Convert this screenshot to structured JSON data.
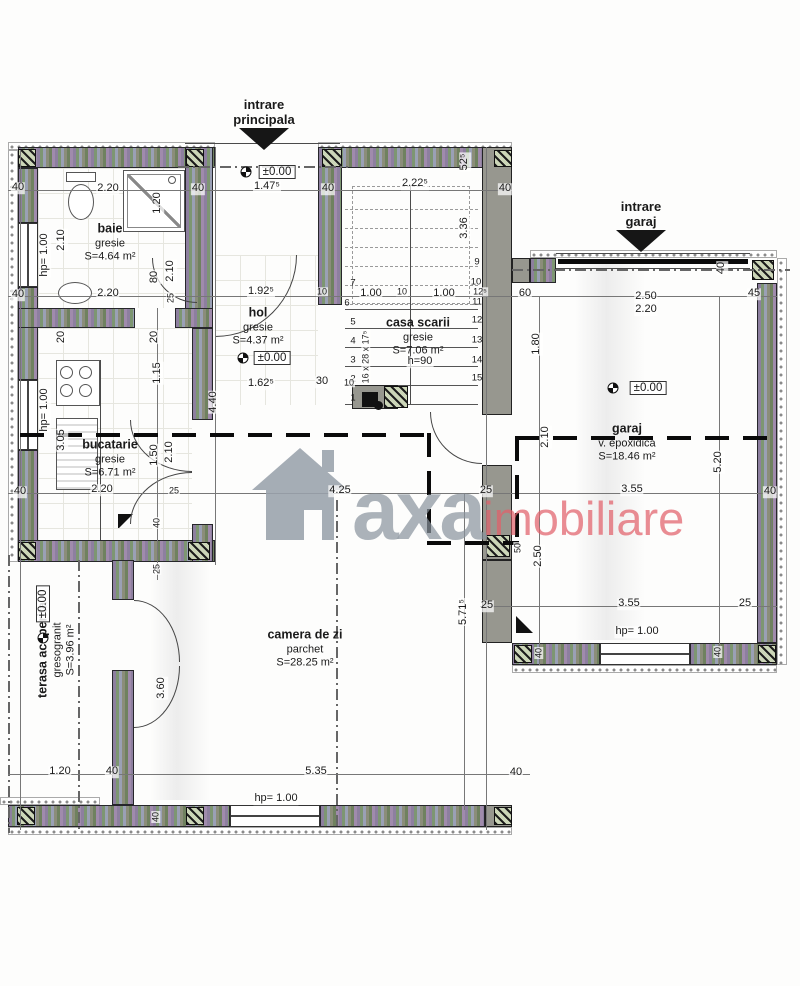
{
  "plan_type": "floor-plan",
  "watermark": {
    "word1": "axa",
    "word2": "imobiliare",
    "gray": "#9aa2ac",
    "red": "#e2606a"
  },
  "entrances": [
    {
      "lines": "intrare\nprincipala",
      "x": 264,
      "y": 98,
      "ax": 264,
      "ay": 128
    },
    {
      "lines": "intrare\ngaraj",
      "x": 641,
      "y": 200,
      "ax": 641,
      "ay": 230
    }
  ],
  "rooms": [
    {
      "id": "baie",
      "name": "baie",
      "finish": "gresie",
      "area": "S=4.64 m²",
      "x": 110,
      "y": 243,
      "rot": false
    },
    {
      "id": "hol",
      "name": "hol",
      "finish": "gresie",
      "area": "S=4.37 m²",
      "x": 258,
      "y": 327,
      "rot": false
    },
    {
      "id": "casa-scarii",
      "name": "casa scarii",
      "finish": "gresie",
      "area": "S=7.06 m²",
      "x": 418,
      "y": 337,
      "rot": false
    },
    {
      "id": "bucatarie",
      "name": "bucatarie",
      "finish": "gresie",
      "area": "S=6.71 m²",
      "x": 110,
      "y": 459,
      "rot": false
    },
    {
      "id": "camera-de-zi",
      "name": "camera de zi",
      "finish": "parchet",
      "area": "S=28.25 m²",
      "x": 305,
      "y": 649,
      "rot": false
    },
    {
      "id": "garaj",
      "name": "garaj",
      "finish": "v. epoxidica",
      "area": "S=18.46 m²",
      "x": 627,
      "y": 443,
      "rot": false
    },
    {
      "id": "terasa-acoperita",
      "name": "terasa acoperita",
      "finish": "gresogranit",
      "area": "S=3.96 m²",
      "x": 57,
      "y": 650,
      "rot": true
    }
  ],
  "levels": {
    "label": "±0.00",
    "items": [
      {
        "bx": 277,
        "by": 172,
        "sx": 246,
        "sy": 172,
        "rot": false
      },
      {
        "bx": 272,
        "by": 358,
        "sx": 243,
        "sy": 358,
        "rot": false
      },
      {
        "bx": 648,
        "by": 388,
        "sx": 613,
        "sy": 388,
        "rot": false
      },
      {
        "bx": 43,
        "by": 604,
        "sx": 43,
        "sy": 638,
        "rot": true
      }
    ]
  },
  "dims": [
    {
      "t": "40",
      "x": 18,
      "y": 188
    },
    {
      "t": "2.20",
      "x": 108,
      "y": 189
    },
    {
      "t": "40",
      "x": 198,
      "y": 189
    },
    {
      "t": "1.47⁵",
      "x": 267,
      "y": 187
    },
    {
      "t": "40",
      "x": 328,
      "y": 189
    },
    {
      "t": "2.22⁵",
      "x": 415,
      "y": 184
    },
    {
      "t": "52⁵",
      "x": 465,
      "y": 162,
      "r": 1
    },
    {
      "t": "40",
      "x": 505,
      "y": 189
    },
    {
      "t": "1.20",
      "x": 158,
      "y": 203,
      "r": 1
    },
    {
      "t": "2.10",
      "x": 62,
      "y": 240,
      "r": 1
    },
    {
      "t": "hp= 1.00",
      "x": 45,
      "y": 255,
      "r": 1
    },
    {
      "t": "80",
      "x": 155,
      "y": 277,
      "r": 1
    },
    {
      "t": "2.10",
      "x": 171,
      "y": 271,
      "r": 1
    },
    {
      "t": "25",
      "x": 171,
      "y": 298,
      "r": 1,
      "s": 1
    },
    {
      "t": "2.20",
      "x": 108,
      "y": 294
    },
    {
      "t": "40",
      "x": 18,
      "y": 295
    },
    {
      "t": "1.92⁵",
      "x": 261,
      "y": 292
    },
    {
      "t": "10",
      "x": 322,
      "y": 292,
      "s": 1
    },
    {
      "t": "1.00",
      "x": 371,
      "y": 294
    },
    {
      "t": "10",
      "x": 402,
      "y": 292,
      "s": 1
    },
    {
      "t": "1.00",
      "x": 444,
      "y": 294
    },
    {
      "t": "12⁵",
      "x": 480,
      "y": 292,
      "s": 1
    },
    {
      "t": "3.36",
      "x": 465,
      "y": 228,
      "r": 1
    },
    {
      "t": "60",
      "x": 525,
      "y": 294
    },
    {
      "t": "2.50",
      "x": 646,
      "y": 297
    },
    {
      "t": "2.20",
      "x": 646,
      "y": 310
    },
    {
      "t": "45",
      "x": 754,
      "y": 294
    },
    {
      "t": "40",
      "x": 722,
      "y": 268,
      "r": 1
    },
    {
      "t": "1.80",
      "x": 537,
      "y": 344,
      "r": 1
    },
    {
      "t": "20",
      "x": 62,
      "y": 337,
      "r": 1
    },
    {
      "t": "20",
      "x": 155,
      "y": 337,
      "r": 1
    },
    {
      "t": "1.15",
      "x": 158,
      "y": 373,
      "r": 1
    },
    {
      "t": "hp= 1.00",
      "x": 45,
      "y": 410,
      "r": 1
    },
    {
      "t": "3.05",
      "x": 62,
      "y": 440,
      "r": 1
    },
    {
      "t": "1.62⁵",
      "x": 261,
      "y": 384
    },
    {
      "t": "30",
      "x": 322,
      "y": 382
    },
    {
      "t": "10",
      "x": 349,
      "y": 383,
      "s": 1
    },
    {
      "t": "4.40",
      "x": 214,
      "y": 402,
      "r": 1
    },
    {
      "t": "h=90",
      "x": 420,
      "y": 362
    },
    {
      "t": "1.50",
      "x": 155,
      "y": 455,
      "r": 1
    },
    {
      "t": "2.10",
      "x": 170,
      "y": 452,
      "r": 1
    },
    {
      "t": "2.20",
      "x": 102,
      "y": 490
    },
    {
      "t": "40",
      "x": 20,
      "y": 492
    },
    {
      "t": "25",
      "x": 174,
      "y": 491,
      "s": 1
    },
    {
      "t": "40",
      "x": 157,
      "y": 523,
      "r": 1,
      "s": 1
    },
    {
      "t": "25",
      "x": 157,
      "y": 569,
      "r": 1,
      "s": 1
    },
    {
      "t": "4.25",
      "x": 340,
      "y": 491
    },
    {
      "t": "25",
      "x": 486,
      "y": 491
    },
    {
      "t": "50",
      "x": 518,
      "y": 548,
      "r": 1,
      "s": 1
    },
    {
      "t": "2.50",
      "x": 539,
      "y": 556,
      "r": 1
    },
    {
      "t": "2.10",
      "x": 546,
      "y": 437,
      "r": 1
    },
    {
      "t": "5.20",
      "x": 719,
      "y": 462,
      "r": 1
    },
    {
      "t": "3.55",
      "x": 632,
      "y": 490
    },
    {
      "t": "40",
      "x": 770,
      "y": 492
    },
    {
      "t": "5.71⁵",
      "x": 464,
      "y": 612,
      "r": 1
    },
    {
      "t": "25",
      "x": 487,
      "y": 606
    },
    {
      "t": "3.55",
      "x": 629,
      "y": 604
    },
    {
      "t": "25",
      "x": 745,
      "y": 604
    },
    {
      "t": "hp= 1.00",
      "x": 637,
      "y": 632
    },
    {
      "t": "40",
      "x": 539,
      "y": 653,
      "r": 1,
      "s": 1
    },
    {
      "t": "40",
      "x": 718,
      "y": 652,
      "r": 1,
      "s": 1
    },
    {
      "t": "3.60",
      "x": 162,
      "y": 688,
      "r": 1
    },
    {
      "t": "1.20",
      "x": 60,
      "y": 772
    },
    {
      "t": "40",
      "x": 112,
      "y": 772
    },
    {
      "t": "5.35",
      "x": 316,
      "y": 772
    },
    {
      "t": "hp= 1.00",
      "x": 276,
      "y": 799
    },
    {
      "t": "40",
      "x": 516,
      "y": 773
    },
    {
      "t": "40",
      "x": 156,
      "y": 817,
      "r": 1,
      "s": 1
    },
    {
      "t": "16 x 28 x 17⁵",
      "x": 366,
      "y": 357,
      "r": 1,
      "s": 1
    }
  ],
  "stair_numbers": [
    {
      "t": "1",
      "x": 353,
      "y": 398
    },
    {
      "t": "2",
      "x": 353,
      "y": 379
    },
    {
      "t": "3",
      "x": 353,
      "y": 360
    },
    {
      "t": "4",
      "x": 353,
      "y": 341
    },
    {
      "t": "5",
      "x": 353,
      "y": 322
    },
    {
      "t": "6",
      "x": 347,
      "y": 303
    },
    {
      "t": "7",
      "x": 353,
      "y": 283
    },
    {
      "t": "9",
      "x": 477,
      "y": 262
    },
    {
      "t": "10",
      "x": 476,
      "y": 282
    },
    {
      "t": "11",
      "x": 477,
      "y": 302
    },
    {
      "t": "12",
      "x": 477,
      "y": 320
    },
    {
      "t": "13",
      "x": 477,
      "y": 340
    },
    {
      "t": "14",
      "x": 477,
      "y": 360
    },
    {
      "t": "15",
      "x": 477,
      "y": 378
    }
  ],
  "colors": {
    "paper": "#fdfdfc",
    "ink": "#1a1a1a",
    "gray_wall": "#97978f",
    "hatch": [
      "#8d7f9f",
      "#7d9672",
      "#9aa0b5",
      "#8b8d7a"
    ],
    "watermark_gray": "#9aa2ac",
    "watermark_red": "#e2606a"
  }
}
